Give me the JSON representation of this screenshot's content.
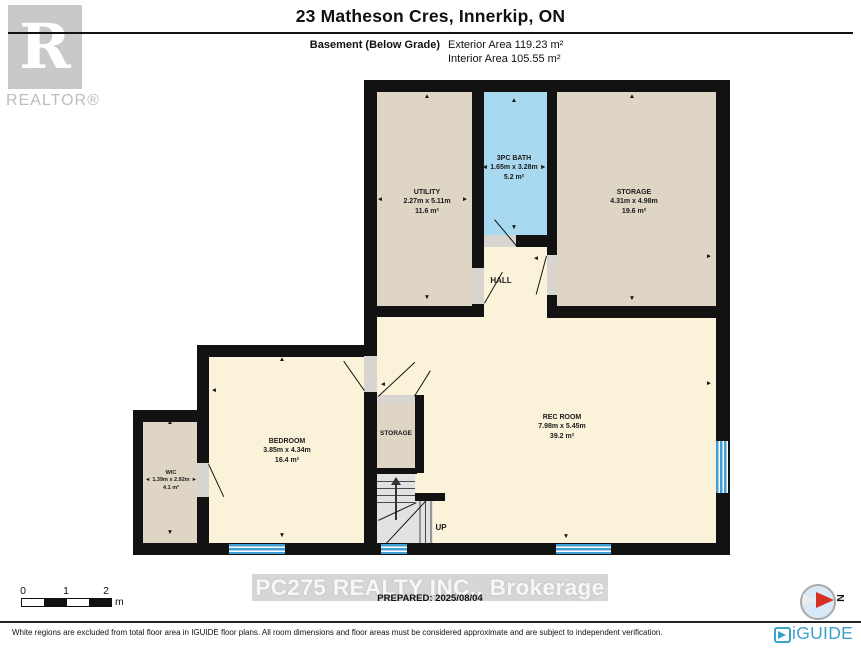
{
  "header": {
    "title": "23 Matheson Cres, Innerkip, ON",
    "floor_label": "Basement (Below Grade)",
    "exterior_area": "Exterior Area 119.23 m²",
    "interior_area": "Interior Area 105.55 m²"
  },
  "realtor_logo": {
    "letter": "R",
    "caption": "REALTOR®"
  },
  "rooms": {
    "utility": {
      "name": "UTILITY",
      "dims": "2.27m x 5.11m",
      "area": "11.6 m²"
    },
    "bath": {
      "name": "3PC BATH",
      "dims": "1.65m x 3.28m",
      "area": "5.2 m²"
    },
    "storage_main": {
      "name": "STORAGE",
      "dims": "4.31m x 4.98m",
      "area": "19.6 m²"
    },
    "hall": {
      "name": "HALL"
    },
    "bedroom": {
      "name": "BEDROOM",
      "dims": "3.85m x 4.34m",
      "area": "16.4 m²"
    },
    "wic": {
      "name": "WIC",
      "dims": "1.39m x 2.92m",
      "area": "4.1 m²"
    },
    "storage_small": {
      "name": "STORAGE"
    },
    "rec_room": {
      "name": "REC ROOM",
      "dims": "7.98m x 5.45m",
      "area": "39.2 m²"
    },
    "stairs": {
      "label": "UP"
    }
  },
  "icons": {
    "arrow_up": "▲",
    "arrow_down": "▼",
    "arrow_left": "◄",
    "arrow_right": "►",
    "compass_letter": "N"
  },
  "scale_bar": {
    "tick0": "0",
    "tick1": "1",
    "tick2": "2",
    "unit": "m"
  },
  "footer": {
    "watermark": "PC275 REALTY INC., Brokerage",
    "prepared": "PREPARED: 2025/08/04",
    "disclaimer": "White regions are excluded from total floor area in IGUIDE floor plans. All room dimensions and floor areas must be considered approximate and are subject to independent verification.",
    "brand": "iGUIDE"
  },
  "colors": {
    "room_tan": "#ded5c5",
    "room_cream": "#faf3da",
    "bath_blue": "#a9d9f1",
    "wall": "#121212",
    "window_blue": "#3f9ed5",
    "iguide_blue": "#3ba3c9",
    "compass_red": "#d93025"
  }
}
